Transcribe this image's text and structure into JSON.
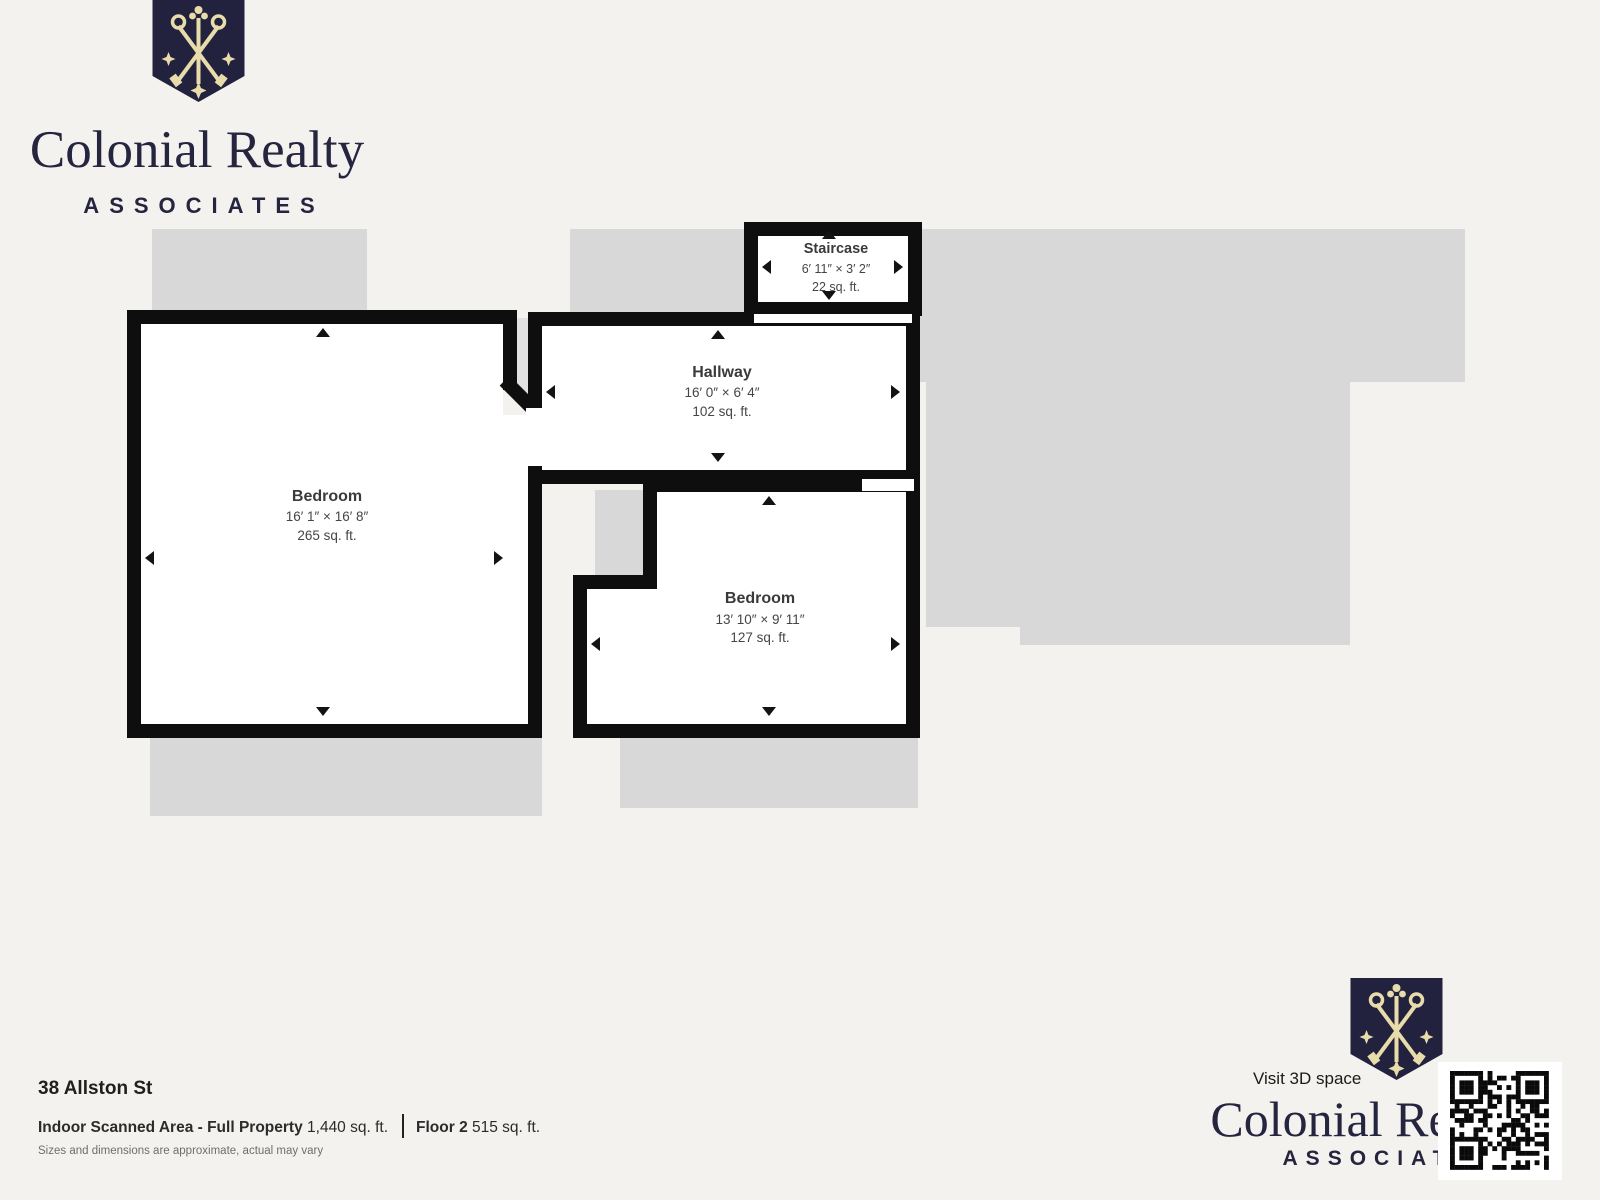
{
  "brand": {
    "wordmark": "Colonial Realty",
    "tagline": "ASSOCIATES",
    "navy": "#23223e",
    "gold": "#e8dcab"
  },
  "plan": {
    "rooms": [
      {
        "name": "Staircase",
        "dims": "6′ 11″ × 3′ 2″",
        "area": "22 sq. ft."
      },
      {
        "name": "Hallway",
        "dims": "16′ 0″ × 6′ 4″",
        "area": "102 sq. ft."
      },
      {
        "name": "Bedroom",
        "dims": "16′ 1″ × 16′ 8″",
        "area": "265 sq. ft."
      },
      {
        "name": "Bedroom",
        "dims": "13′ 10″ × 9′ 11″",
        "area": "127 sq. ft."
      }
    ]
  },
  "footer": {
    "address": "38 Allston St",
    "area_label": "Indoor Scanned Area - Full Property",
    "area_value": "1,440 sq. ft.",
    "floor_label": "Floor 2",
    "floor_value": "515 sq. ft.",
    "disclaimer": "Sizes and dimensions are approximate, actual may vary"
  },
  "cta": {
    "visit_3d": "Visit 3D space"
  },
  "colors": {
    "background": "#f4f2ef",
    "underlay": "#d8d8d8",
    "wall": "#0e0e0e"
  }
}
